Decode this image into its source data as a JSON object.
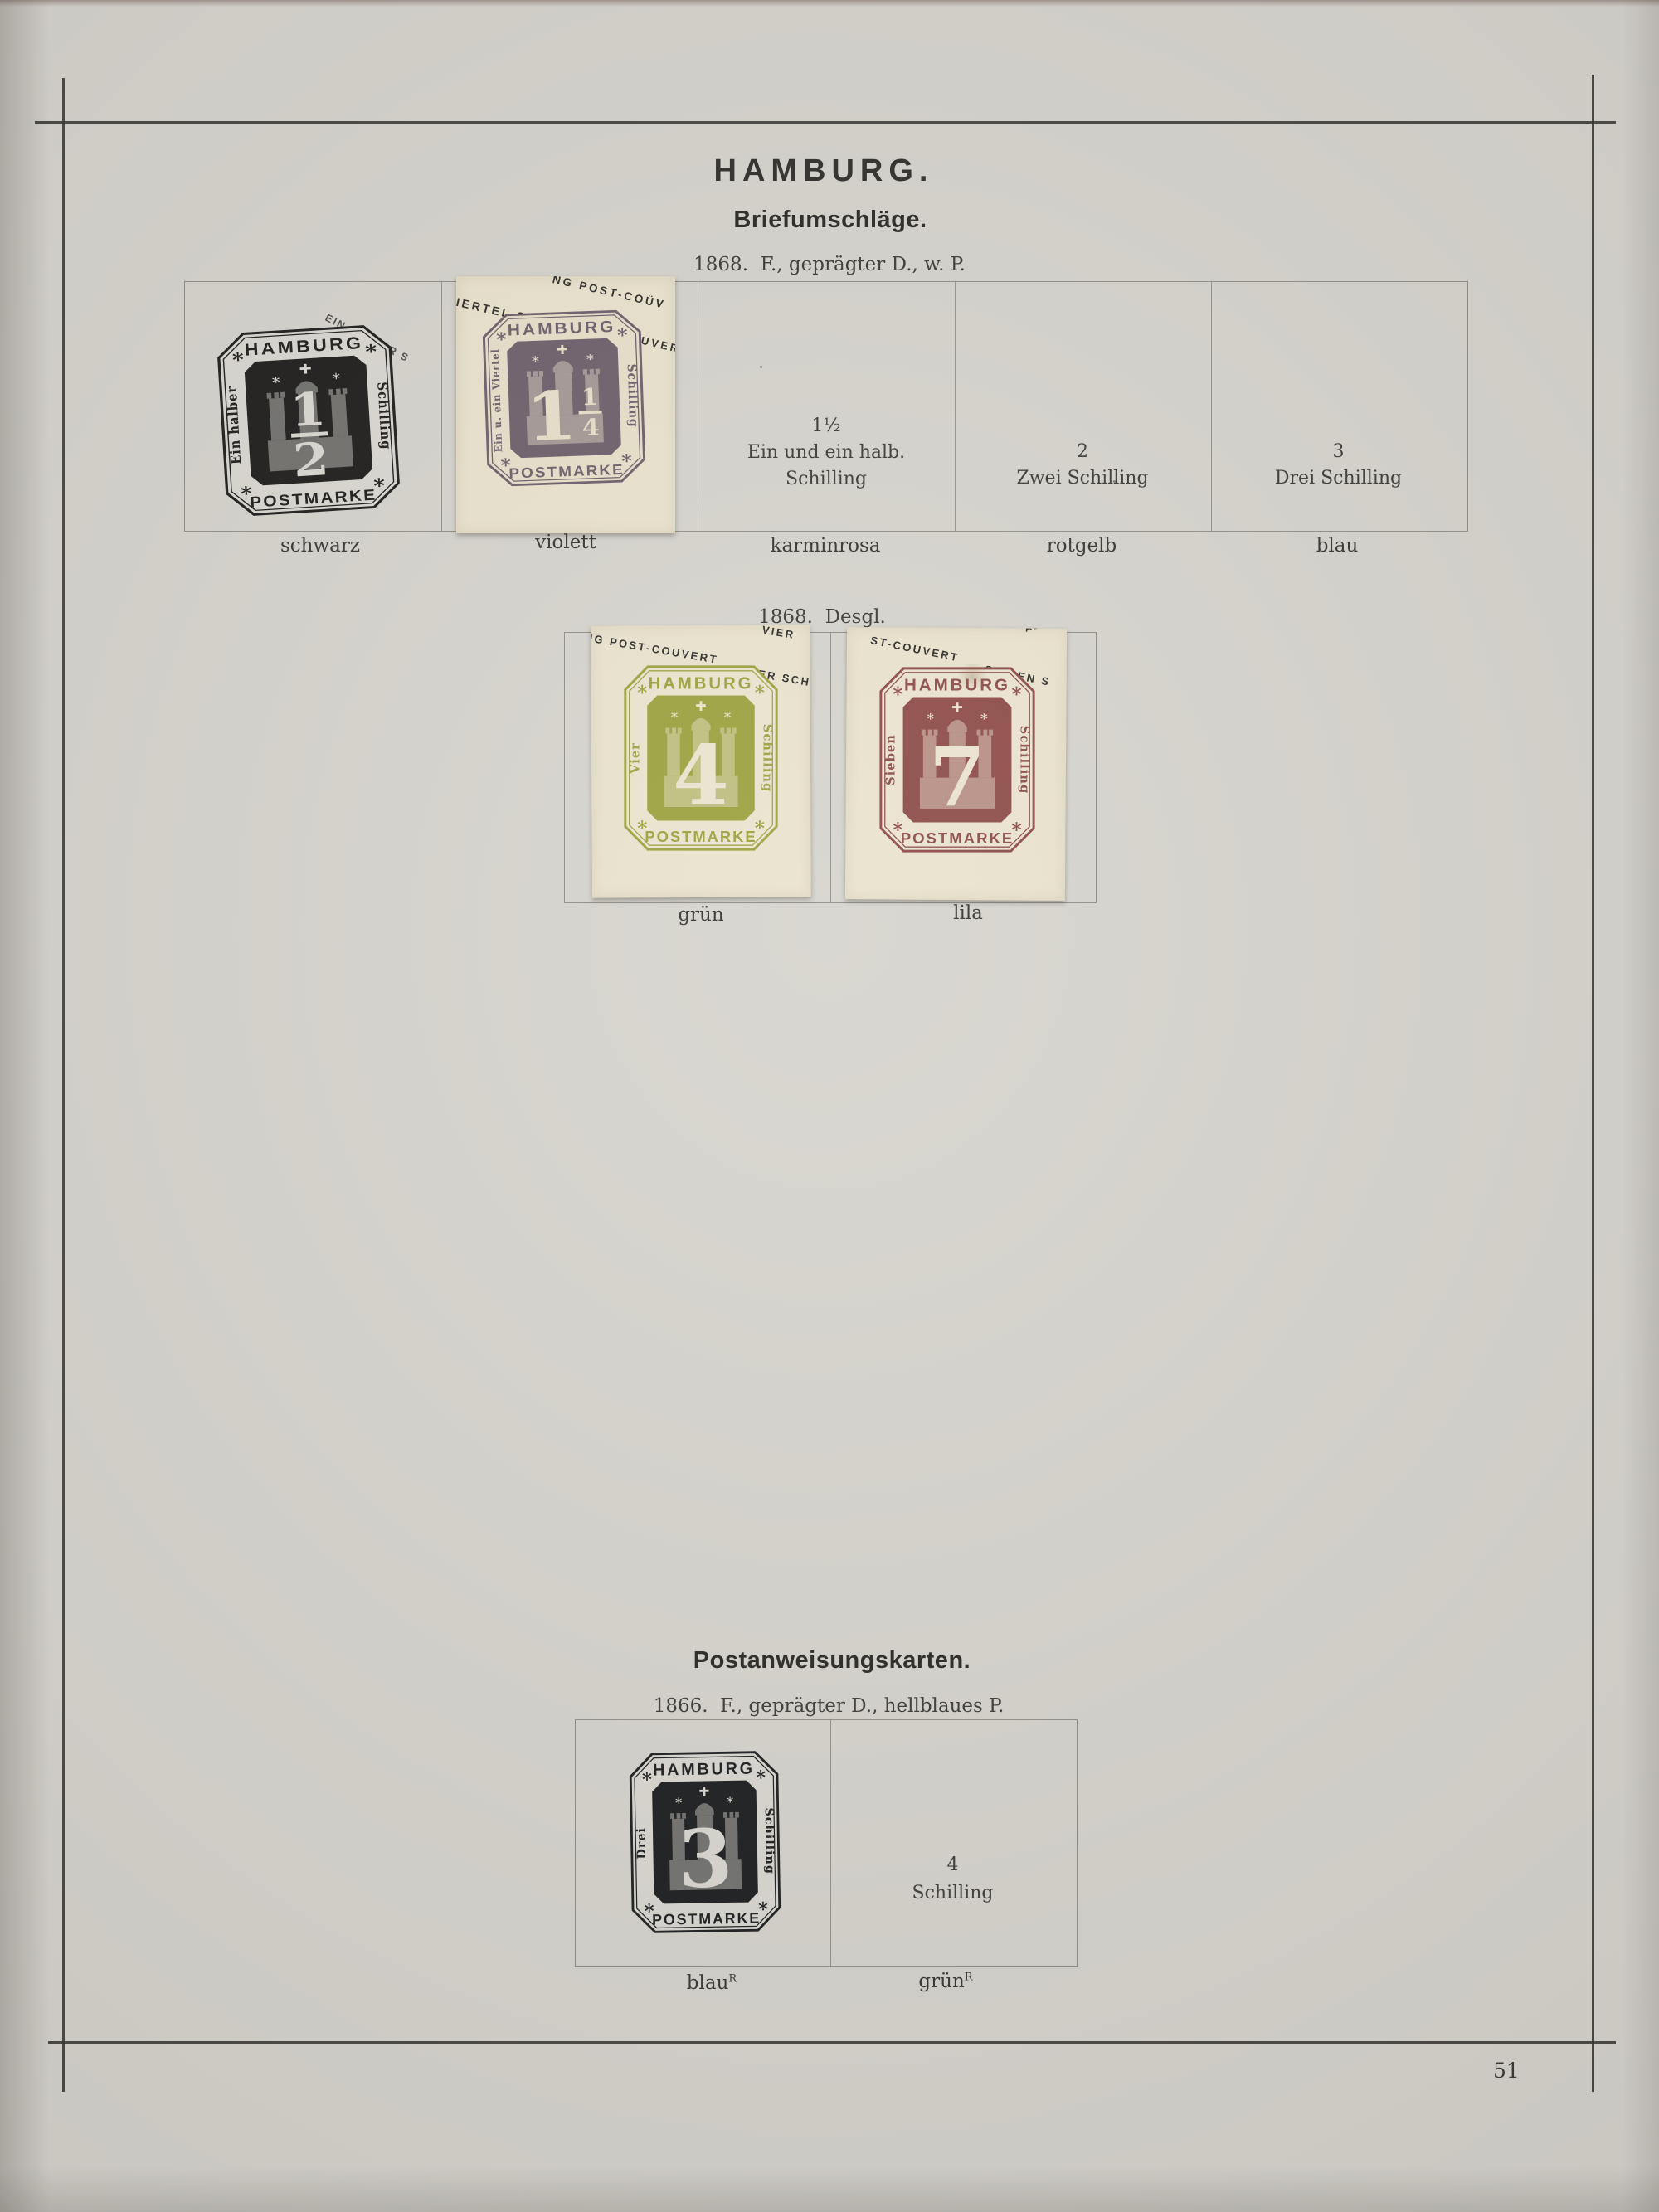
{
  "page": {
    "number": "51"
  },
  "header": {
    "title": "HAMBURG."
  },
  "sections": {
    "briefumschlaege": {
      "heading": "Briefumschläge.",
      "issue": "1868.  F., geprägter D., w. P.",
      "cells": [
        {
          "label": "schwarz"
        },
        {
          "label": "violett"
        },
        {
          "value_lines": [
            "1½",
            "Ein und ein halb.",
            "Schilling"
          ],
          "label": "karminrosa"
        },
        {
          "value_lines": [
            "2",
            "Zwei Schilling"
          ],
          "label": "rotgelb"
        },
        {
          "value_lines": [
            "3",
            "Drei Schilling"
          ],
          "label": "blau"
        }
      ]
    },
    "desgl": {
      "issue": "1868.  Desgl.",
      "cells": [
        {
          "label": "grün"
        },
        {
          "label": "lila"
        }
      ]
    },
    "postanweisungskarten": {
      "heading": "Postanweisungskarten.",
      "issue": "1866.  F., geprägter D., hellblaues P.",
      "cells": [
        {
          "label": "blau",
          "label_sup": "R"
        },
        {
          "value_lines": [
            "4",
            "Schilling"
          ],
          "label": "grün",
          "label_sup": "R"
        }
      ]
    }
  },
  "stamps": {
    "schwarz": {
      "ink": "#1b1a18",
      "paper": "#dad8d1",
      "top": "HAMBURG",
      "bottom": "POSTMARKE",
      "left": "Ein halber",
      "right": "Schilling",
      "value": "1/2"
    },
    "violett": {
      "ink": "#6d5e6a",
      "paper": "#e8e0ca",
      "top": "HAMBURG",
      "bottom": "POSTMARKE",
      "left": "Ein u. ein Viertel",
      "right": "Schilling",
      "value": "1 1/4"
    },
    "gruen": {
      "ink": "#9ba23d",
      "paper": "#ebe4cf",
      "top": "HAMBURG",
      "bottom": "POSTMARKE",
      "left": "Vier",
      "right": "Schilling",
      "value": "4"
    },
    "lila": {
      "ink": "#8d4b47",
      "paper": "#ece4d1",
      "top": "HAMBURG",
      "bottom": "POSTMARKE",
      "left": "Sieben",
      "right": "Schilling",
      "value": "7"
    },
    "drei": {
      "ink": "#191a1c",
      "paper": "#dad8d1",
      "top": "HAMBURG",
      "bottom": "POSTMARKE",
      "left": "Drei",
      "right": "Schilling",
      "value": "3"
    }
  },
  "overprints": {
    "page_half": "EIN HALBER S",
    "violett": {
      "a": "NG POST-COÜV",
      "b": "VIERTEL SCHILLING",
      "c": "COUVER"
    },
    "gruen": {
      "a": "NG POST-COUVERT",
      "b": "VIER SCH",
      "c": "VIER"
    },
    "lila": {
      "a": "ST-COUVERT",
      "b": "SIEBEN S",
      "c": "ABEI"
    }
  }
}
